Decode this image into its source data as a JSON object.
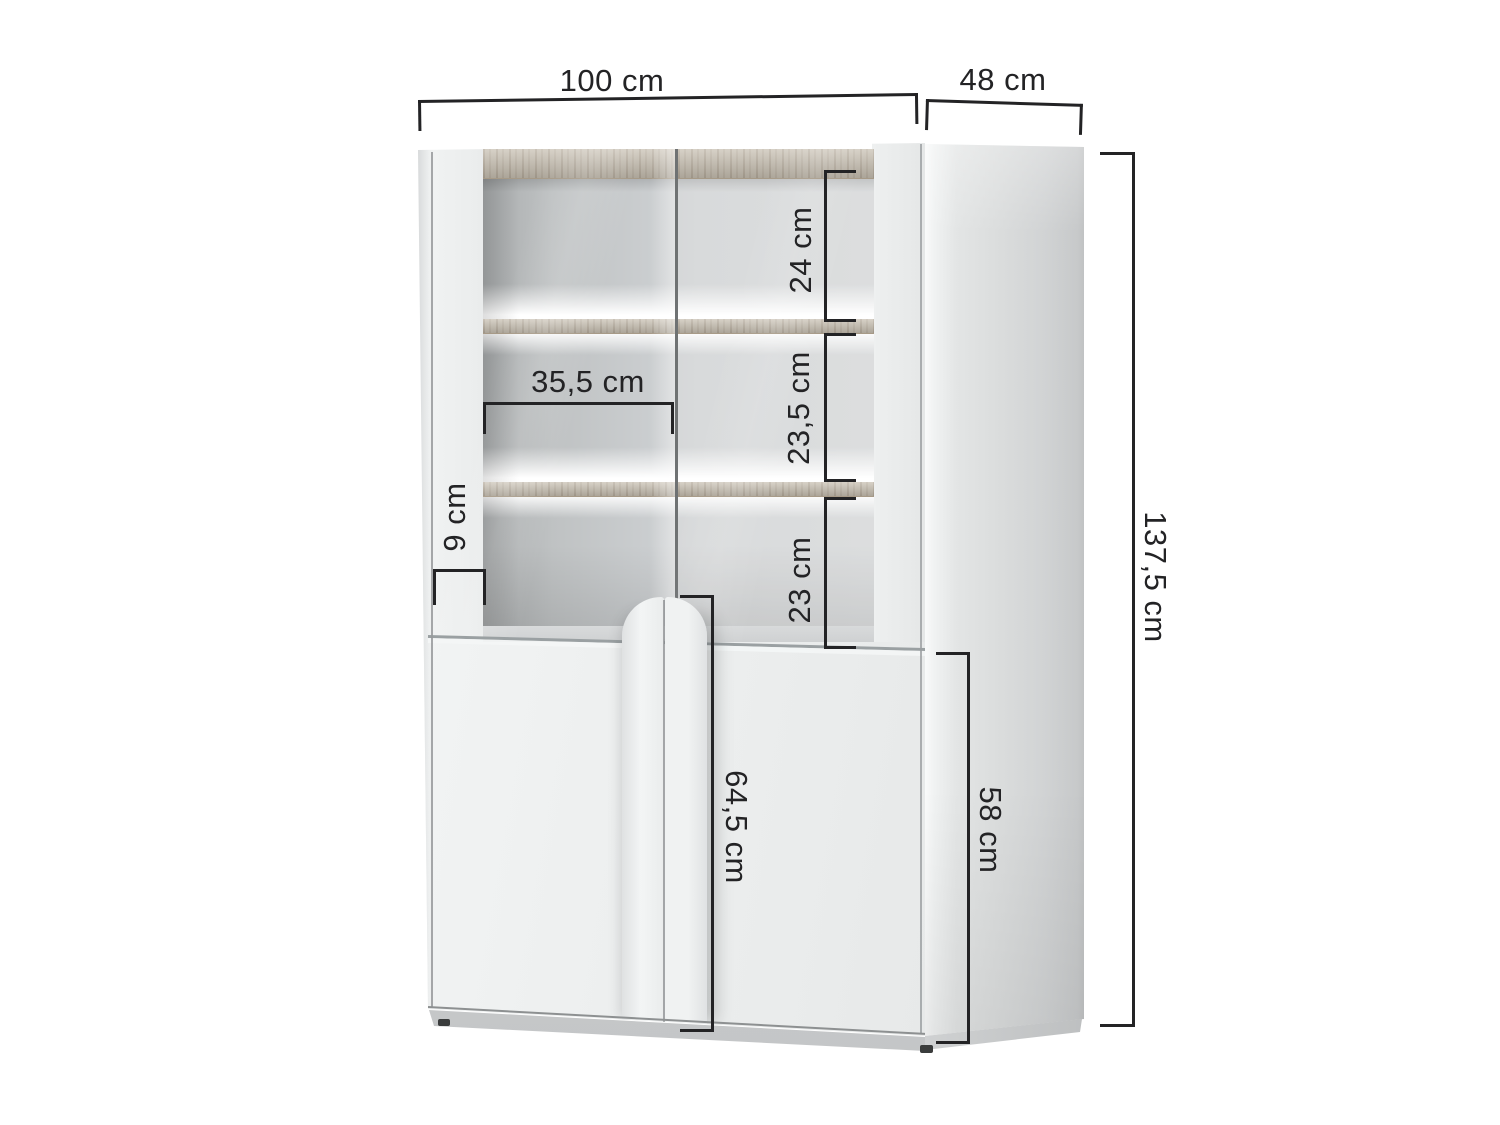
{
  "diagram": {
    "kind": "furniture dimension diagram",
    "subject": "display cabinet with glass doors, lit wooden shelves, arched centre handles and two lower doors",
    "unit": "cm"
  },
  "dimensions": {
    "overall_width": {
      "label": "100 cm",
      "value_cm": 100
    },
    "overall_depth": {
      "label": "48 cm",
      "value_cm": 48
    },
    "overall_height": {
      "label": "137,5 cm",
      "value_cm": 137.5
    },
    "top_shelf_space": {
      "label": "24 cm",
      "value_cm": 24
    },
    "middle_shelf_space": {
      "label": "23,5 cm",
      "value_cm": 23.5
    },
    "bottom_shelf_space": {
      "label": "23 cm",
      "value_cm": 23
    },
    "inner_width": {
      "label": "35,5 cm",
      "value_cm": 35.5
    },
    "bottom_rail_height": {
      "label": "9 cm",
      "value_cm": 9
    },
    "door_height": {
      "label": "64,5 cm",
      "value_cm": 64.5
    },
    "lower_cabinet_height": {
      "label": "58 cm",
      "value_cm": 58
    }
  },
  "colors": {
    "background": "#ffffff",
    "ink": "#232325",
    "cabinet_white": "#eef0f0",
    "interior_gray": "#c9cccd",
    "wood": "#c8c0b2",
    "glow": "#ffffff",
    "plinth": "#c9cbcc"
  }
}
